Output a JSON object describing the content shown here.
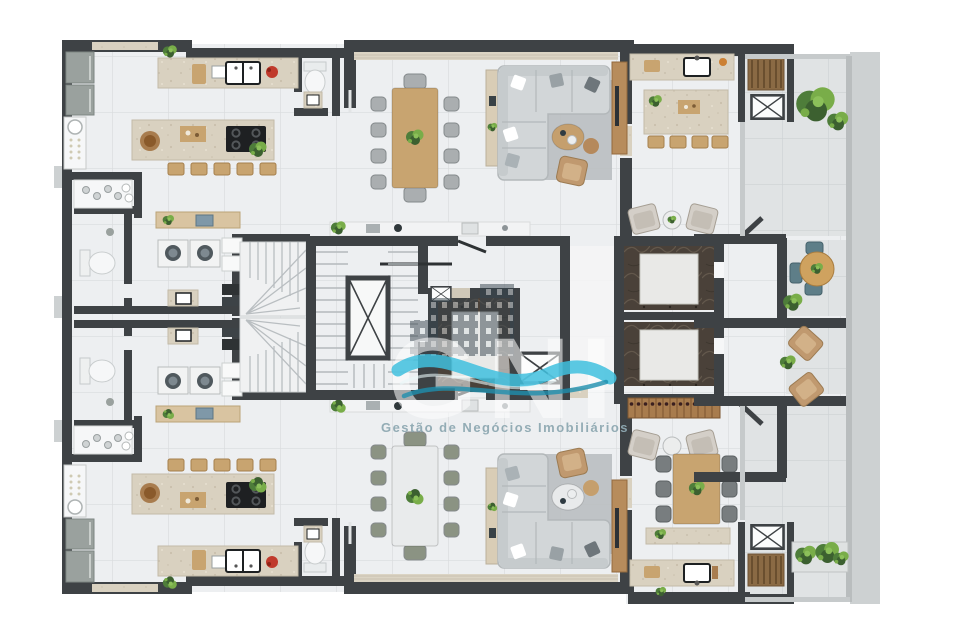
{
  "watermark": {
    "brand_initials": "GNI",
    "tagline": "Gestão de Negócios Imobiliários"
  },
  "icons": {
    "duct_shaft": "x-cross-shaft-icon",
    "stairs": "stair-treads-icon",
    "elevator": "elevator-cab-icon"
  },
  "palette": {
    "background": "#ffffff",
    "wall": "#3e4245",
    "wall_soft": "#2e3234",
    "floor": "#edeff1",
    "tile_line": "#d9dcde",
    "balcony_floor": "#e0e3e4",
    "balcony_tile_line": "#cdd1d3",
    "concrete": "#cdd1d2",
    "glass": "#c6cacb",
    "counter_stone": "#d9d1c0",
    "stone_border": "#c2baa8",
    "wood": "#c8a470",
    "wood_dark": "#a87c4e",
    "wood_shelf": "#d9c4a1",
    "marble": "#4a4139",
    "marble_vein": "#6e6254",
    "pad": "#e9e9e7",
    "appliance": "#9aa19e",
    "fixture": "#f6f7f8",
    "sofa": "#d2d6d8",
    "sofa_line": "#b3b8ba",
    "rug": "#b9bec1",
    "chair_gray": "#aaaeb0",
    "chair_olive": "#8b9383",
    "chair_teal": "#5e7e88",
    "chair_dark": "#787d7f",
    "armchair_tan": "#c0996f",
    "lounge": "#d4cfc8",
    "table_white": "#e9ebec",
    "coffee_wood": "#c59f6d",
    "coffee_white": "#e8eaeb",
    "plant": "#4e7d3a",
    "plant_light": "#79ad49",
    "red": "#c03a2c",
    "cooktop": "#1e2022",
    "wave": "#3fc0de",
    "wave_dark": "#1e8fae",
    "tagline_color": "#8fa9b2"
  }
}
